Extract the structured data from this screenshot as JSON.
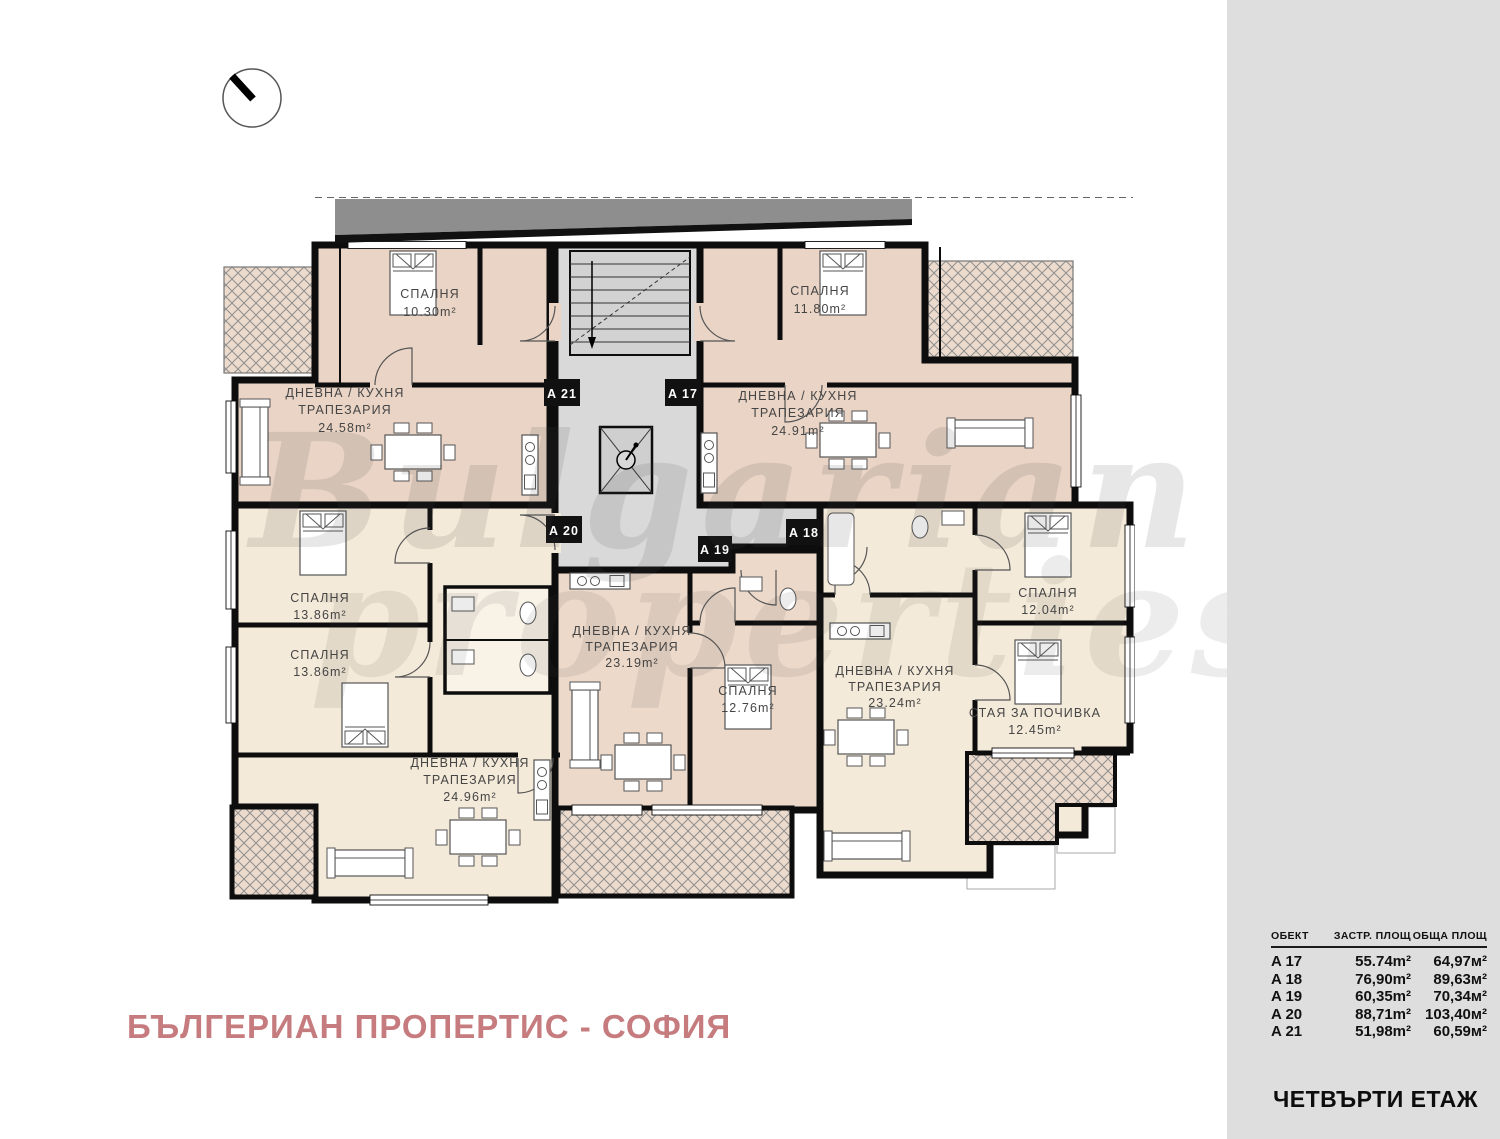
{
  "watermark": {
    "line1": "Bulgarian",
    "line2": "properties"
  },
  "footer": {
    "company_title": "БЪЛГЕРИАН ПРОПЕРТИС - СОФИЯ"
  },
  "sidebar": {
    "floor_title": "ЧЕТВЪРТИ ЕТАЖ",
    "table": {
      "headers": {
        "unit": "ОБЕКТ",
        "built": "ЗАСТР. ПЛОЩ",
        "total": "ОБЩА ПЛОЩ"
      },
      "rows": [
        {
          "unit": "A 17",
          "built": "55.74m²",
          "total": "64,97м²"
        },
        {
          "unit": "A 18",
          "built": "76,90m²",
          "total": "89,63м²"
        },
        {
          "unit": "A 19",
          "built": "60,35m²",
          "total": "70,34м²"
        },
        {
          "unit": "A 20",
          "built": "88,71m²",
          "total": "103,40м²"
        },
        {
          "unit": "A 21",
          "built": "51,98m²",
          "total": "60,59м²"
        }
      ]
    }
  },
  "plan": {
    "unit_labels": {
      "a17": "A 17",
      "a18": "A 18",
      "a19": "A 19",
      "a20": "A 20",
      "a21": "A 21"
    },
    "rooms": {
      "a21_bedroom": {
        "name": "СПАЛНЯ",
        "area": "10.30m²"
      },
      "a21_living": {
        "name1": "ДНЕВНА / КУХНЯ",
        "name2": "ТРАПЕЗАРИЯ",
        "area": "24.58m²"
      },
      "a17_bedroom": {
        "name": "СПАЛНЯ",
        "area": "11.80m²"
      },
      "a17_living": {
        "name1": "ДНЕВНА / КУХНЯ",
        "name2": "ТРАПЕЗАРИЯ",
        "area": "24.91m²"
      },
      "a20_bedroom1": {
        "name": "СПАЛНЯ",
        "area": "13.86m²"
      },
      "a20_bedroom2": {
        "name": "СПАЛНЯ",
        "area": "13.86m²"
      },
      "a20_living": {
        "name1": "ДНЕВНА / КУХНЯ",
        "name2": "ТРАПЕЗАРИЯ",
        "area": "24.96m²"
      },
      "a19_living": {
        "name1": "ДНЕВНА / КУХНЯ",
        "name2": "ТРАПЕЗАРИЯ",
        "area": "23.19m²"
      },
      "a19_bedroom": {
        "name": "СПАЛНЯ",
        "area": "12.76m²"
      },
      "a18_living": {
        "name1": "ДНЕВНА / КУХНЯ",
        "name2": "ТРАПЕЗАРИЯ",
        "area": "23.24m²"
      },
      "a18_bedroom": {
        "name": "СПАЛНЯ",
        "area": "12.04m²"
      },
      "a18_rest": {
        "name": "СТАЯ ЗА ПОЧИВКА",
        "area": "12.45m²"
      }
    }
  },
  "colors": {
    "room_pink": "#e9d4c5",
    "room_pink_light": "#ecd9ca",
    "room_cream": "#f4ead9",
    "terrace_hatch": "#ecdacc",
    "core_gray": "#d9d9d9",
    "roof_gray": "#8e8e8e",
    "wall_black": "#0d0d0d",
    "sidebar_gray": "#dedede",
    "title_pink": "#c67c7e"
  }
}
